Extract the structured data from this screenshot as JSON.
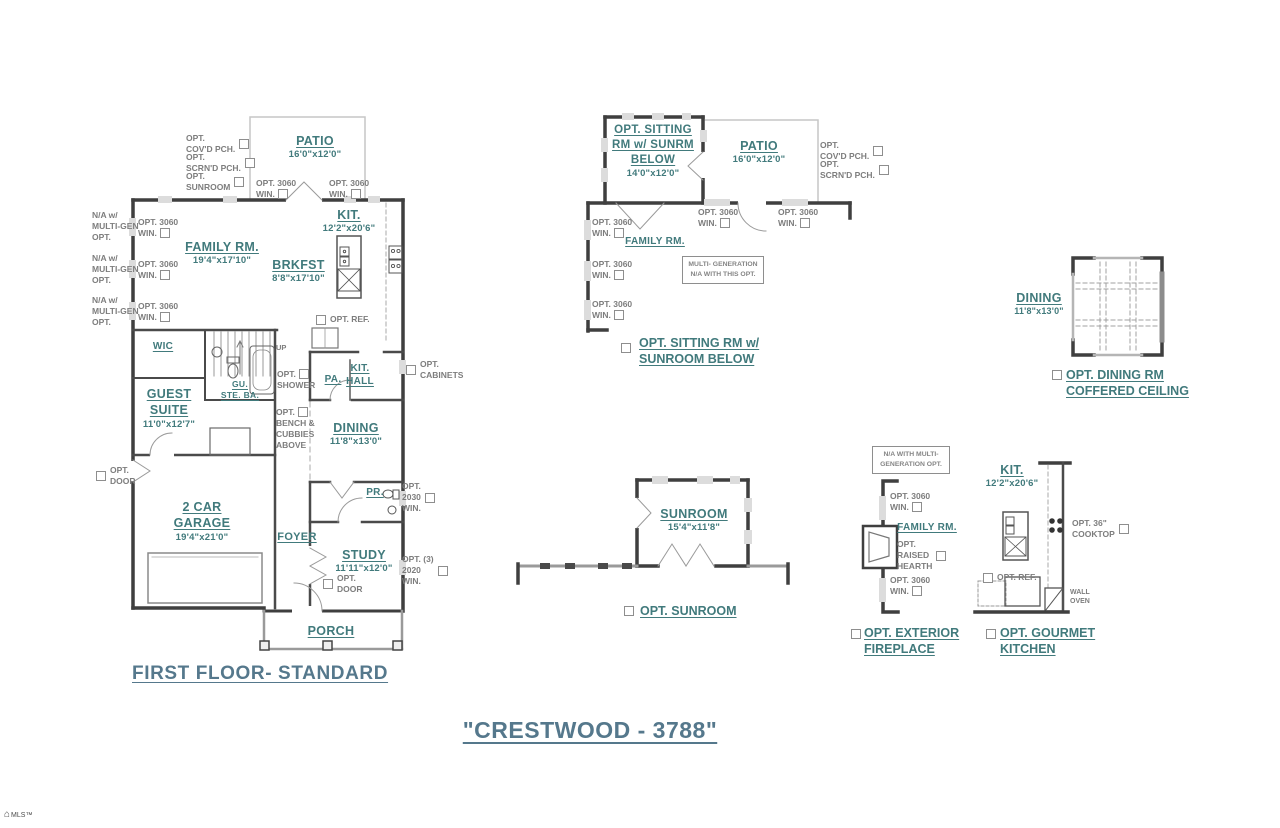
{
  "title": "\"CRESTWOOD - 3788\"",
  "watermark": "MLS™",
  "colors": {
    "room_label": "#417a7c",
    "heading": "#55788c",
    "option_text": "#7d7d7d",
    "wall_dark": "#3f3f3f",
    "wall_light": "#c6c6c6"
  },
  "shared": {
    "opt3060": {
      "l1": "OPT. 3060",
      "l2": "WIN."
    },
    "na_multigen": {
      "l1": "N/A w/",
      "l2": "MULTI-GEN",
      "l3": "OPT."
    },
    "opt_covd": {
      "l1": "OPT.",
      "l2": "COV'D PCH."
    },
    "opt_scrnd": {
      "l1": "OPT.",
      "l2": "SCRN'D PCH."
    },
    "opt_ref": "OPT. REF."
  },
  "main_plan": {
    "caption": "FIRST FLOOR- STANDARD",
    "patio": {
      "name": "PATIO",
      "dims": "16'0\"x12'0\""
    },
    "opt_sunroom": {
      "l1": "OPT.",
      "l2": "SUNROOM"
    },
    "family_rm": {
      "name": "FAMILY RM.",
      "dims": "19'4\"x17'10\""
    },
    "brkfst": {
      "name": "BRKFST",
      "dims": "8'8\"x17'10\""
    },
    "kit": {
      "name": "KIT.",
      "dims": "12'2\"x20'6\""
    },
    "wic": "WIC",
    "up": "UP",
    "gu_ste_ba": {
      "l1": "GU.",
      "l2": "STE. BA."
    },
    "opt_shower": {
      "l1": "OPT.",
      "l2": "SHOWER"
    },
    "pa": "PA.",
    "kit_hall": {
      "l1": "KIT.",
      "l2": "HALL"
    },
    "opt_cabinets": {
      "l1": "OPT.",
      "l2": "CABINETS"
    },
    "guest_suite": {
      "l1": "GUEST",
      "l2": "SUITE",
      "dims": "11'0\"x12'7\""
    },
    "opt_bench": {
      "l1": "OPT.",
      "l2": "BENCH &",
      "l3": "CUBBIES",
      "l4": "ABOVE"
    },
    "dining": {
      "name": "DINING",
      "dims": "11'8\"x13'0\""
    },
    "opt_door": {
      "l1": "OPT.",
      "l2": "DOOR"
    },
    "garage": {
      "l1": "2 CAR",
      "l2": "GARAGE",
      "dims": "19'4\"x21'0\""
    },
    "pr": "PR.",
    "opt_2030": {
      "l1": "OPT.",
      "l2": "2030",
      "l3": "WIN."
    },
    "foyer": "FOYER",
    "study": {
      "name": "STUDY",
      "dims": "11'11\"x12'0\""
    },
    "opt_2020": {
      "l1": "OPT. (3)",
      "l2": "2020",
      "l3": "WIN."
    },
    "porch": "PORCH"
  },
  "sitting_plan": {
    "room": {
      "l1": "OPT. SITTING",
      "l2": "RM w/ SUNRM",
      "l3": "BELOW",
      "dims": "14'0\"x12'0\""
    },
    "patio": {
      "name": "PATIO",
      "dims": "16'0\"x12'0\""
    },
    "family_rm": "FAMILY RM.",
    "note": {
      "l1": "MULTI- GENERATION",
      "l2": "N/A WITH THIS OPT."
    },
    "caption": {
      "l1": "OPT. SITTING RM w/",
      "l2": "SUNROOM BELOW"
    }
  },
  "dining_plan": {
    "room": {
      "name": "DINING",
      "dims": "11'8\"x13'0\""
    },
    "caption": {
      "l1": "OPT. DINING RM",
      "l2": "COFFERED CEILING"
    }
  },
  "sunroom_plan": {
    "room": {
      "name": "SUNROOM",
      "dims": "15'4\"x11'8\""
    },
    "caption": "OPT. SUNROOM"
  },
  "fireplace_plan": {
    "note": {
      "l1": "N/A WITH MULTI-",
      "l2": "GENERATION OPT."
    },
    "family_rm": "FAMILY RM.",
    "opt_hearth": {
      "l1": "OPT.",
      "l2": "RAISED",
      "l3": "HEARTH"
    },
    "caption": {
      "l1": "OPT. EXTERIOR",
      "l2": "FIREPLACE"
    }
  },
  "gourmet_plan": {
    "kit": {
      "name": "KIT.",
      "dims": "12'2\"x20'6\""
    },
    "opt_cooktop": {
      "l1": "OPT. 36\"",
      "l2": "COOKTOP"
    },
    "wall_oven": {
      "l1": "WALL",
      "l2": "OVEN"
    },
    "caption": {
      "l1": "OPT. GOURMET",
      "l2": "KITCHEN"
    }
  }
}
